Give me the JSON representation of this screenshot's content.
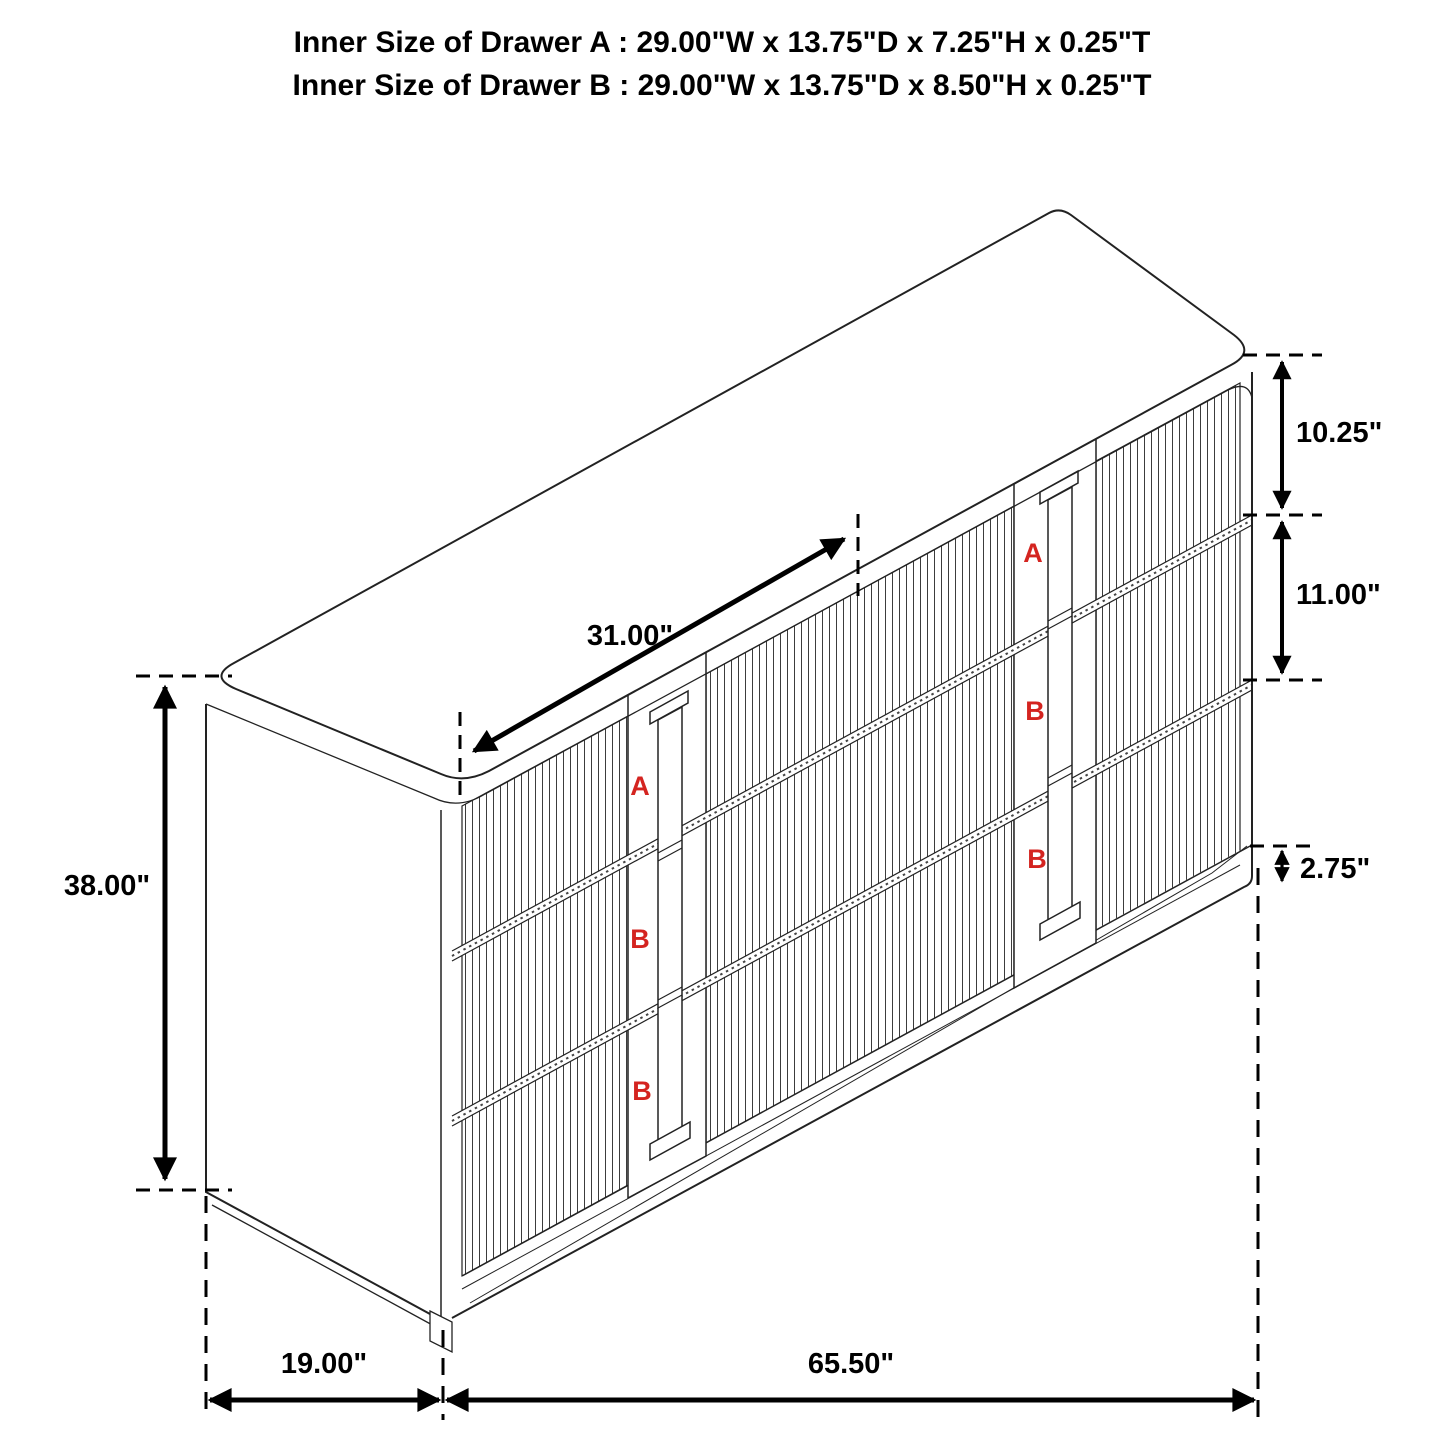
{
  "title": {
    "line1": "Inner Size of Drawer A : 29.00\"W x 13.75\"D x 7.25\"H x 0.25\"T",
    "line2": "Inner Size of Drawer B : 29.00\"W x 13.75\"D x 8.50\"H x 0.25\"T"
  },
  "dimensions": {
    "drawer_a_height": "10.25\"",
    "drawer_b_height": "11.00\"",
    "base_height": "2.75\"",
    "drawer_width": "31.00\"",
    "cabinet_height": "38.00\"",
    "cabinet_depth": "19.00\"",
    "cabinet_width": "65.50\""
  },
  "drawer_labels": {
    "left_bank": [
      "A",
      "B",
      "B"
    ],
    "right_bank": [
      "A",
      "B",
      "B"
    ]
  },
  "colors": {
    "line": "#222222",
    "label_red": "#d42420",
    "text": "#000000",
    "background": "#ffffff"
  }
}
